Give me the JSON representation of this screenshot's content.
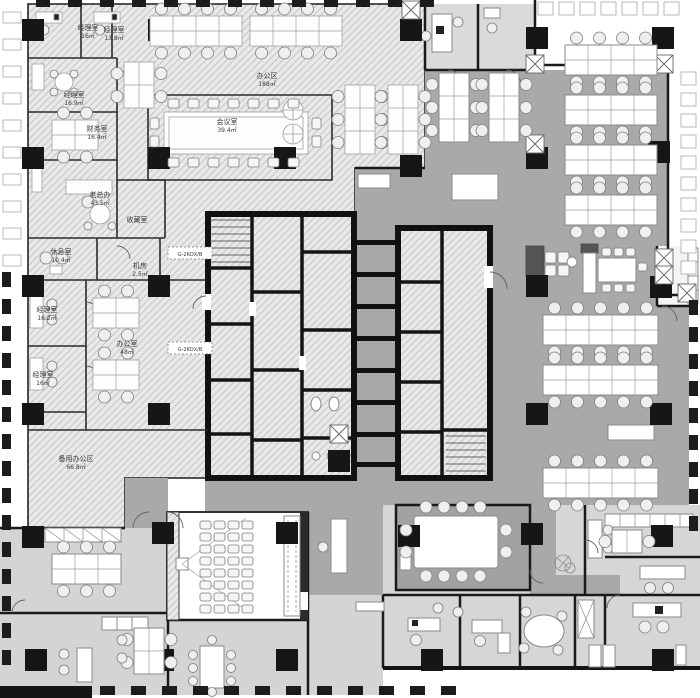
{
  "drawing_type": "office-floor-plan",
  "rooms": [
    {
      "label": "经理室",
      "area": "16㎡"
    },
    {
      "label": "经理室",
      "area": "13.8㎡"
    },
    {
      "label": "经理室",
      "area": "16.9㎡"
    },
    {
      "label": "财务室",
      "area": "16.4㎡"
    },
    {
      "label": "办公区",
      "area": "188㎡"
    },
    {
      "label": "会议室",
      "area": "39.4㎡"
    },
    {
      "label": "老总办",
      "area": "43.5㎡"
    },
    {
      "label": "收藏室",
      "area": ""
    },
    {
      "label": "休息室",
      "area": "10.4㎡"
    },
    {
      "label": "机房",
      "area": "2.5㎡"
    },
    {
      "label": "经理室",
      "area": "16.2㎡"
    },
    {
      "label": "经理室",
      "area": "16㎡"
    },
    {
      "label": "办公室",
      "area": "48㎡"
    },
    {
      "label": "备用办公区",
      "area": "66.8㎡"
    }
  ],
  "equipment_tags": [
    {
      "label": "G-2KDX/B"
    },
    {
      "label": "G-2KDX/B"
    }
  ],
  "colors": {
    "background": "#ffffff",
    "hatch_fill": "#e9e9e9",
    "hatch_line": "#c6c6c6",
    "open_office_floor": "#a9a9a9",
    "secondary_floor": "#d4d4d4",
    "room_floor": "#dadada",
    "wall": "#141414",
    "furniture_fill": "#ffffff",
    "furniture_stroke": "#8a8a8a"
  }
}
